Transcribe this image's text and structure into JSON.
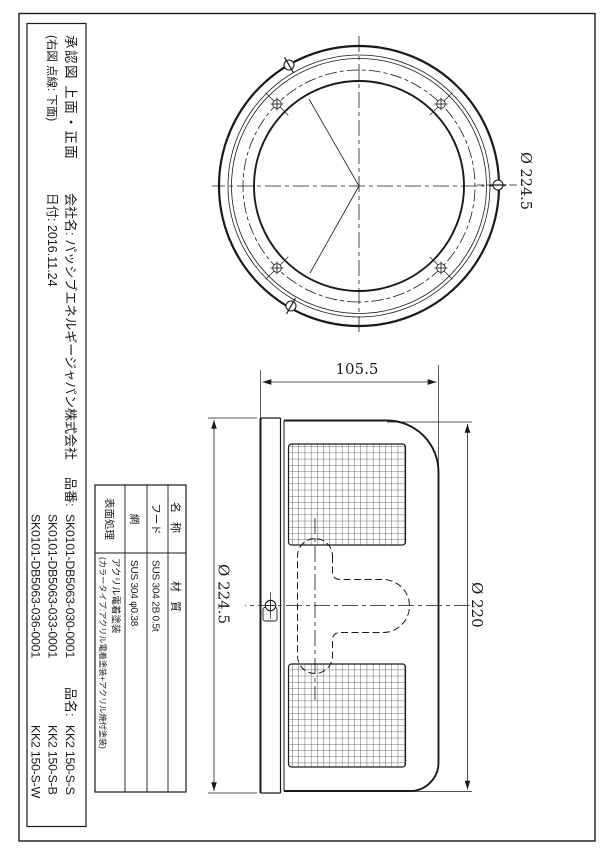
{
  "sheet": {
    "orientation_note": "landscape engineering drawing rotated 90deg on portrait page"
  },
  "title_block": {
    "approval": "承認図 上面・正面",
    "note": "(右図 点線: 下面)",
    "company": "会社名: パッシブエネルギージャパン株式会社",
    "date": "日付: 2016.11.24",
    "part_no_label": "品番:",
    "part_numbers": [
      "SK0101-DB5063-030-0001",
      "SK0101-DB5063-033-0001",
      "SK0101-DB5063-036-0001"
    ],
    "part_name_label": "品名:",
    "part_names": [
      "KK2 150-S-S",
      "KK2 150-S-B",
      "KK2 150-S-W"
    ]
  },
  "parts_table": {
    "headers": {
      "name": "名 称",
      "material": "材 質"
    },
    "rows": [
      {
        "name": "フード",
        "material": "SUS 304 2B 0.5t"
      },
      {
        "name": "網",
        "material": "SUS 304 φ0.38"
      },
      {
        "name": "表面処理",
        "material": "アクリル電着塗装",
        "material2": "(カラータイプ:アクリル電着塗装+アクリル焼付塗装)"
      }
    ]
  },
  "dimensions": {
    "top_view_outer_dia": "Ø 224.5",
    "front_depth": "105.5",
    "front_flange_dia": "Ø 224.5",
    "front_body_dia": "Ø 220"
  },
  "colors": {
    "line": "#1a1a1a",
    "background": "#ffffff"
  }
}
